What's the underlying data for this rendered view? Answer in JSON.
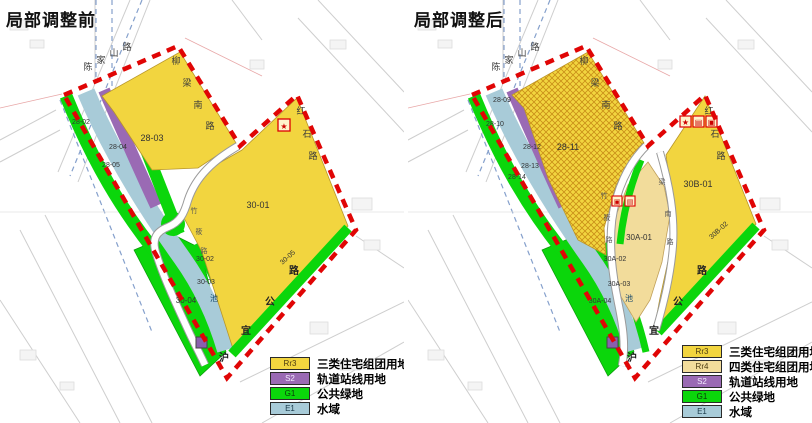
{
  "titles": {
    "left": "局部调整前",
    "right": "局部调整后"
  },
  "colors": {
    "rr3": "#f2d53f",
    "rr4": "#f2dc9b",
    "s2": "#9a6ab4",
    "g1": "#0bd60b",
    "e1": "#a8cbd8",
    "boundary": "#e00505"
  },
  "roads": {
    "chenjiashan": [
      "陈",
      "家",
      "山",
      "路"
    ],
    "liuliangnan": [
      "柳",
      "梁",
      "南",
      "路"
    ],
    "hongshi": [
      "红",
      "石",
      "路"
    ],
    "huyi": [
      "沪",
      "宜",
      "公",
      "路"
    ],
    "internal": [
      "竹",
      "筱",
      "路"
    ],
    "liuliang_south": [
      "梁",
      "南",
      "路"
    ]
  },
  "left_map": {
    "parcels": {
      "p2802": "28-02",
      "p2804": "28-04",
      "p2805": "28-05",
      "p2803": "28-03",
      "p3001": "30-01",
      "p3002": "30-02",
      "p3003": "30-03",
      "p3004": "30-04",
      "p3005": "30-05"
    },
    "water_label": "池",
    "star_marker": "★"
  },
  "right_map": {
    "parcels": {
      "p2809": "28-09",
      "p2810": "28-10",
      "p2812": "28-12",
      "p2813": "28-13",
      "p2814": "28-14",
      "p2811": "28-11",
      "p30a01": "30A-01",
      "p30a02": "30A-02",
      "p30a03": "30A-03",
      "p30a04": "30A-04",
      "p30b01": "30B-01",
      "p30b02": "30B-02"
    },
    "water_label": "池",
    "facility_markers": [
      "★",
      "▤",
      "▣"
    ],
    "site_markers": [
      "▣",
      "▤"
    ]
  },
  "legend": {
    "left": {
      "items": [
        {
          "code": "Rr3",
          "label": "三类住宅组团用地",
          "color": "#f2d53f"
        },
        {
          "code": "S2",
          "label": "轨道站线用地",
          "color": "#9a6ab4"
        },
        {
          "code": "G1",
          "label": "公共绿地",
          "color": "#0bd60b"
        },
        {
          "code": "E1",
          "label": "水域",
          "color": "#a8cbd8"
        }
      ]
    },
    "right": {
      "items": [
        {
          "code": "Rr3",
          "label": "三类住宅组团用地",
          "color": "#f2d53f"
        },
        {
          "code": "Rr4",
          "label": "四类住宅组团用地",
          "color": "#f2dc9b"
        },
        {
          "code": "S2",
          "label": "轨道站线用地",
          "color": "#9a6ab4"
        },
        {
          "code": "G1",
          "label": "公共绿地",
          "color": "#0bd60b"
        },
        {
          "code": "E1",
          "label": "水域",
          "color": "#a8cbd8"
        }
      ]
    }
  }
}
